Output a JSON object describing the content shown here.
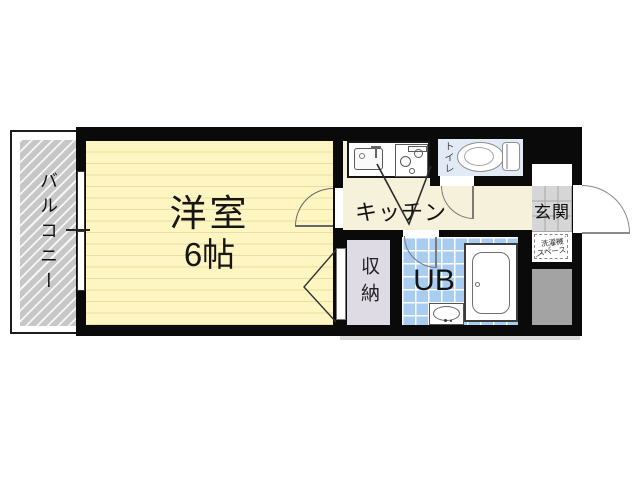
{
  "floorplan": {
    "rooms": {
      "balcony": {
        "label": "バルコニー"
      },
      "western_room": {
        "label": "洋室",
        "size": "6帖"
      },
      "kitchen": {
        "label": "キッチン"
      },
      "toilet": {
        "label": "トイレ"
      },
      "entrance": {
        "label": "玄関"
      },
      "storage": {
        "label": "収納"
      },
      "unit_bath": {
        "label": "UB"
      },
      "washer_space": {
        "line1": "洗濯機",
        "line2": "スペース"
      }
    },
    "colors": {
      "wall": "#0a0a0a",
      "room_floor": "#fdf6c2",
      "room_floor_line": "#ecdf9e",
      "kitchen_floor": "#f6f1da",
      "toilet_floor": "#e2eaf6",
      "bath_tile": "#a9cdf0",
      "entrance_tile": "#d6d6d6",
      "storage_floor": "#dedbe4",
      "balcony_fill": "#c7c7c7",
      "shaft": "#a3a3a3"
    }
  }
}
